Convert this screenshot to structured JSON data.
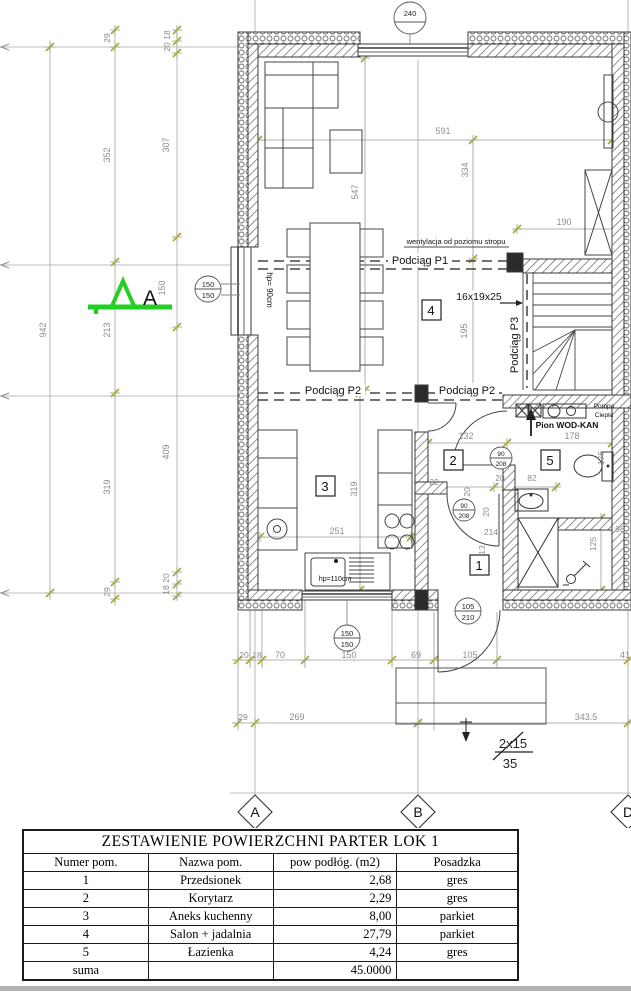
{
  "plan": {
    "section_label": "A",
    "axis_labels": {
      "a": "A",
      "b": "B",
      "d": "D"
    },
    "beams": {
      "p1": "Podciąg P1",
      "p2a": "Podciąg P2",
      "p2b": "Podciąg P2",
      "p3": "Podciąg P3"
    },
    "notes": {
      "vent": "wentylacja od poziomu stropu",
      "stair_spec": "16x19x25",
      "wodkan": "Pion WOD-KAN",
      "pompa1": "Pompa",
      "pompa2": "Ciepła",
      "hp_window": "hp= 90cm",
      "hp_kitchen": "hp=110cm",
      "steps_num": "2x15",
      "steps_den": "35"
    },
    "rooms": {
      "r1": "1",
      "r2": "2",
      "r3": "3",
      "r4": "4",
      "r5": "5"
    },
    "markers": {
      "m240": "240",
      "m150a_w": "150",
      "m150a_h": "150",
      "m150b_w": "150",
      "m150b_h": "150",
      "m105_w": "105",
      "m105_h": "210",
      "m90a_w": "90",
      "m90a_h": "208",
      "m90b_w": "90",
      "m90b_h": "208"
    },
    "dims": {
      "v942": "942",
      "v29a": "29",
      "v352": "352",
      "v213": "213",
      "v319": "319",
      "v29b": "29",
      "v18a": "18",
      "v20a": "20",
      "v307": "307",
      "v150": "150",
      "v409": "409",
      "v20b": "20",
      "v18b": "18",
      "d591": "591",
      "d334": "334",
      "d547": "547",
      "d190": "190",
      "d195": "195",
      "d132": "132",
      "d178": "178",
      "d82": "82",
      "d20c": "20",
      "d22": "22",
      "d20d": "20",
      "d20e": "20",
      "d214": "214",
      "d13": "13",
      "d98": "98",
      "d125": "125",
      "d176": "176",
      "d251": "251",
      "d319": "319",
      "b20": "20",
      "b18": "18",
      "b70": "70",
      "b150": "150",
      "b69": "69",
      "b105": "105",
      "b41": "41",
      "c29": "29",
      "c269": "269",
      "c343": "343.5"
    }
  },
  "table": {
    "title": "ZESTAWIENIE POWIERZCHNI PARTER LOK 1",
    "headers": [
      "Numer pom.",
      "Nazwa pom.",
      "pow podłóg. (m2)",
      "Posadzka"
    ],
    "rows": [
      [
        "1",
        "Przedsionek",
        "2,68",
        "gres"
      ],
      [
        "2",
        "Korytarz",
        "2,29",
        "gres"
      ],
      [
        "3",
        "Aneks kuchenny",
        "8,00",
        "parkiet"
      ],
      [
        "4",
        "Salon + jadalnia",
        "27,79",
        "parkiet"
      ],
      [
        "5",
        "Łazienka",
        "4,24",
        "gres"
      ],
      [
        "suma",
        "",
        "45.0000",
        ""
      ]
    ]
  }
}
